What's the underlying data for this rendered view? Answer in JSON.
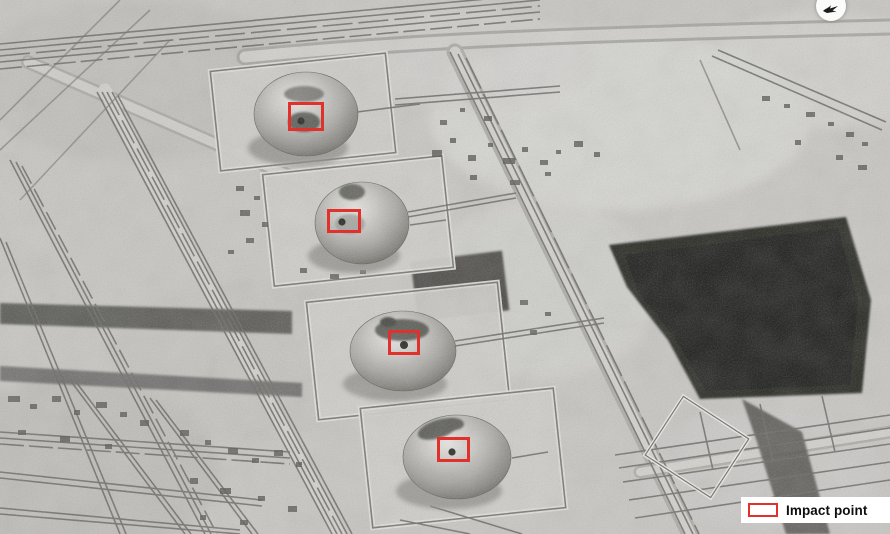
{
  "image": {
    "kind": "black-and-white overhead satellite photograph",
    "subject": "oil processing facility with four spheroid storage tanks, pipe racks and a dark pond; four strike locations outlined in red"
  },
  "colors": {
    "accent_red": "#e0312c",
    "sand": "#c9c7c3",
    "pond": "#1e1e1c",
    "legend_bg": "#ffffff",
    "legend_text": "#0e0e0e"
  },
  "legend": {
    "label": "Impact point",
    "swatch": "red-outline-rectangle"
  },
  "compass": {
    "icon": "north-arrow-icon"
  },
  "impact_points": [
    {
      "id": 1,
      "x": 288,
      "y": 102,
      "w": 36,
      "h": 29
    },
    {
      "id": 2,
      "x": 327,
      "y": 209,
      "w": 34,
      "h": 24
    },
    {
      "id": 3,
      "x": 388,
      "y": 330,
      "w": 32,
      "h": 25
    },
    {
      "id": 4,
      "x": 437,
      "y": 437,
      "w": 33,
      "h": 25
    }
  ]
}
